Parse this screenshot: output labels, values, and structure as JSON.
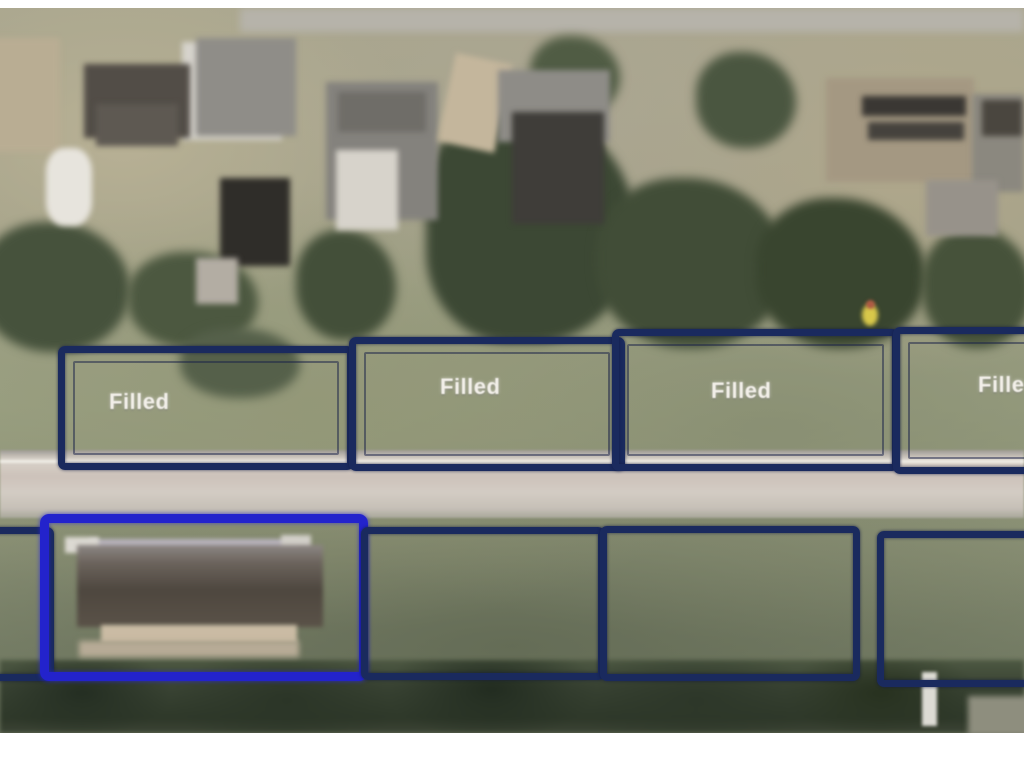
{
  "image": {
    "type": "aerial-parcel-map",
    "description": "Aerial photograph of a residential street with parcel boundary overlays; four lots across the street are marked Filled and one highlighted lot contains a building"
  },
  "parcels": {
    "top_row": [
      {
        "id": "filled-1",
        "label": "Filled"
      },
      {
        "id": "filled-2",
        "label": "Filled"
      },
      {
        "id": "filled-3",
        "label": "Filled"
      },
      {
        "id": "filled-4",
        "label": "Filled"
      }
    ],
    "bottom_row": [
      {
        "id": "edge-partial-lot",
        "label": ""
      },
      {
        "id": "highlighted-lot",
        "label": ""
      },
      {
        "id": "vacant-lot-1",
        "label": ""
      },
      {
        "id": "vacant-lot-2",
        "label": ""
      },
      {
        "id": "vacant-lot-3",
        "label": ""
      }
    ]
  },
  "colors": {
    "parcel_outline": "#1a2a5e",
    "highlight_outline": "#2323cc",
    "label_text": "#f2efe9",
    "road": "#cdc5bc",
    "tree_line": "#2e3829",
    "grass": "#9aa082",
    "page_background": "#ffffff"
  }
}
